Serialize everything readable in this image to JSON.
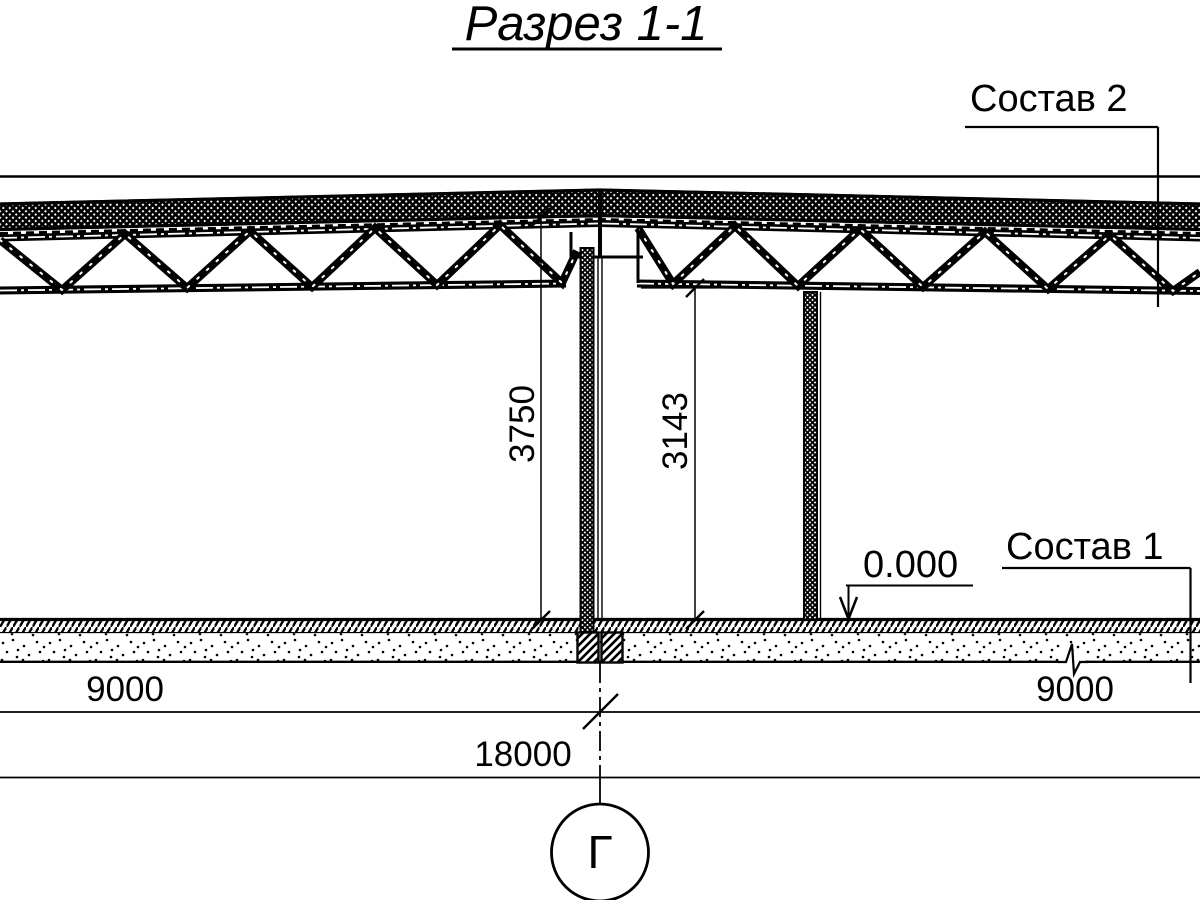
{
  "title": "Разрез 1-1",
  "callouts": {
    "roof_composition": "Состав 2",
    "floor_composition": "Состав 1",
    "elevation_mark": "0.000"
  },
  "dimensions": {
    "height_to_ridge": "3750",
    "height_to_truss_bottom": "3143",
    "span_left": "9000",
    "span_right": "9000",
    "total_span": "18000"
  },
  "axis": {
    "label": "Г"
  },
  "colors": {
    "line": "#000000",
    "background": "#ffffff"
  }
}
